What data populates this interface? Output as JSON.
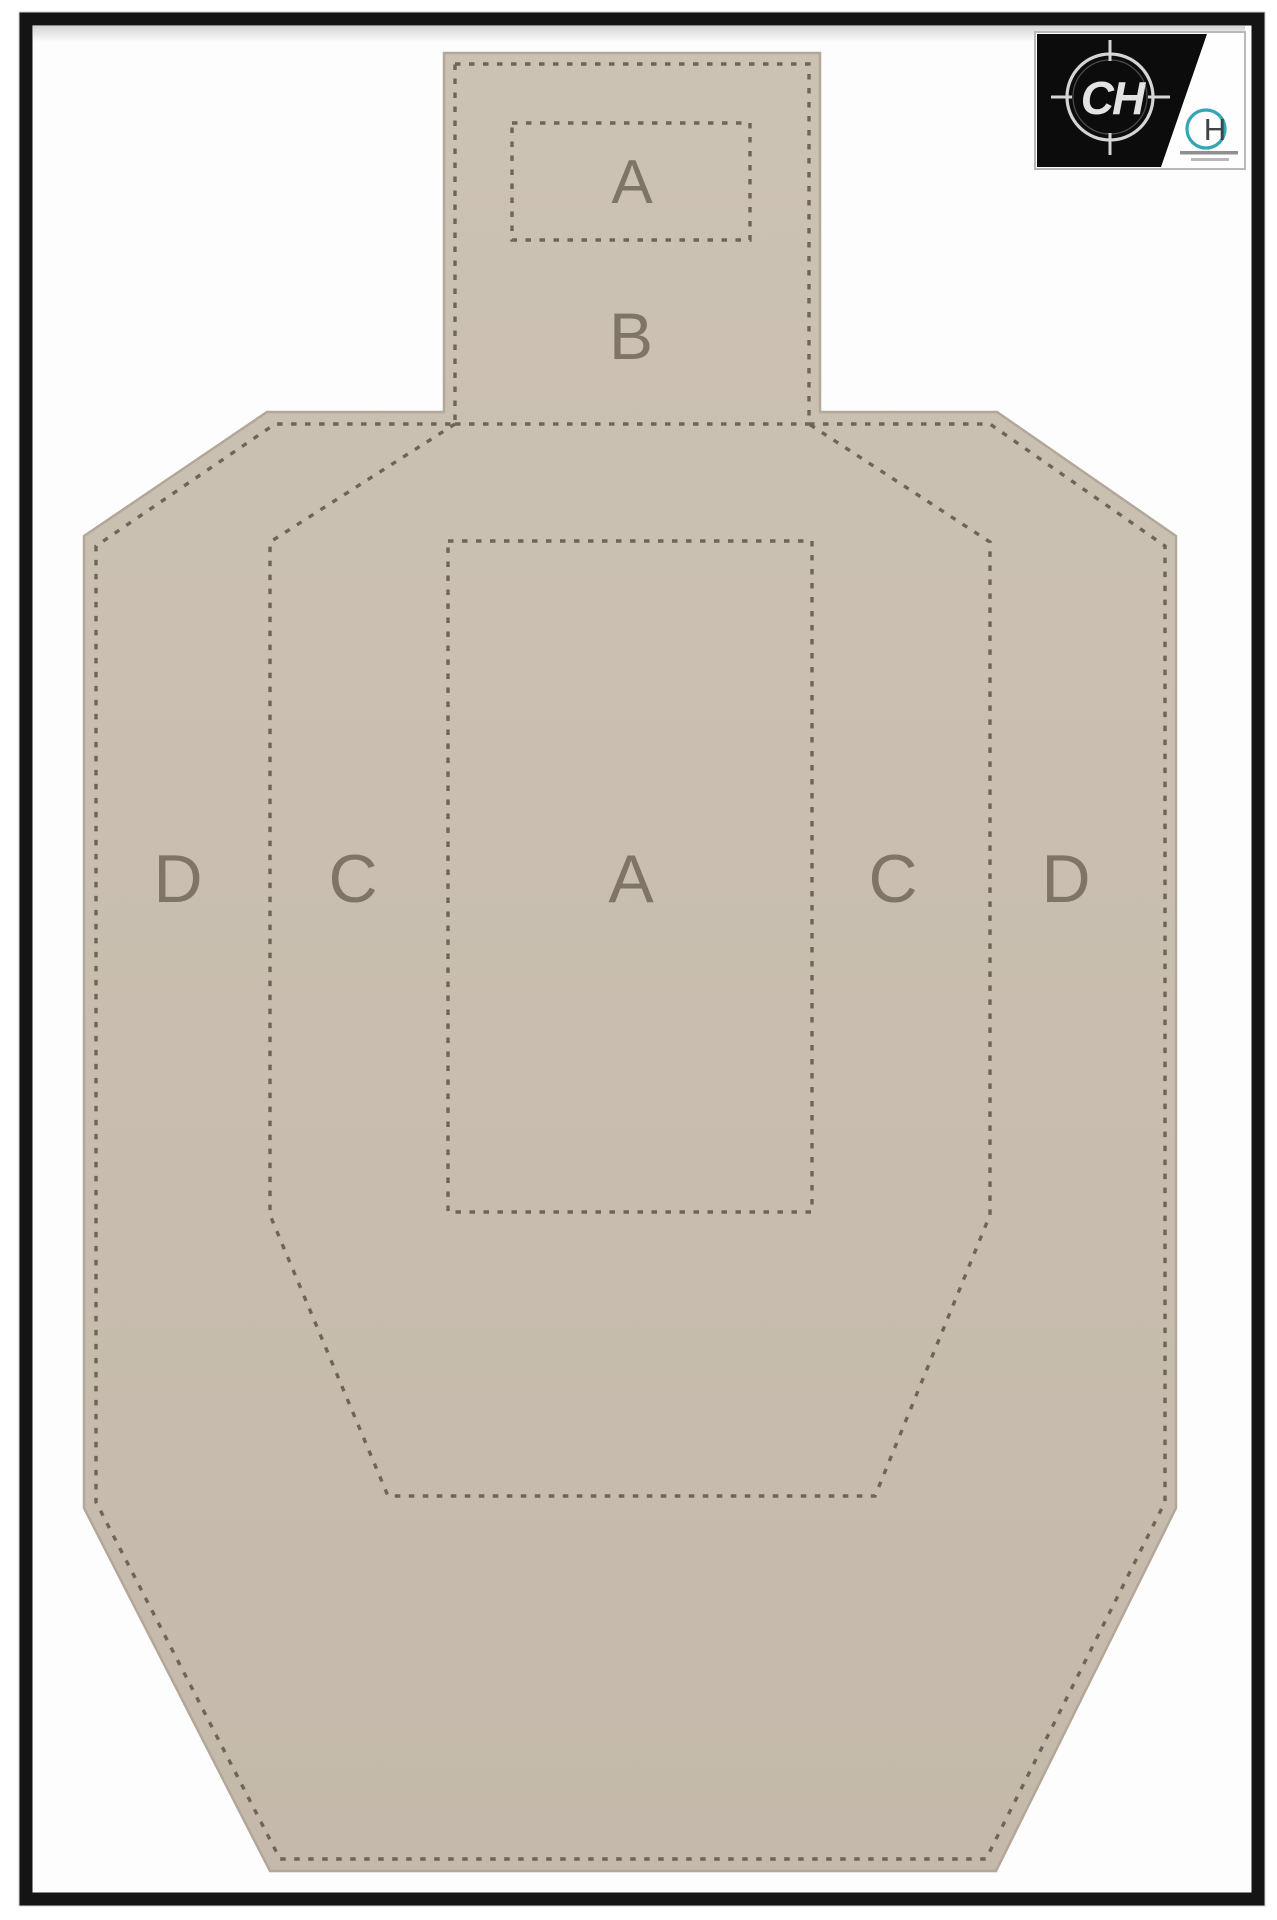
{
  "scene": {
    "description": "Framed photo of a USPSA/IPSC cardboard practice target with perforated scoring zones"
  },
  "frame": {
    "color": "#141414"
  },
  "target": {
    "cardboard_color": "#c8bdae",
    "perforation_color": "#6e6458",
    "letter_color": "#7f7566",
    "zones": {
      "head_a": "A",
      "head_b": "B",
      "body_row": [
        "D",
        "C",
        "A",
        "C",
        "D"
      ]
    }
  },
  "logo": {
    "monogram": "CH",
    "submark": "H",
    "teal": "#35a6b4",
    "black": "#0c0c0c"
  }
}
